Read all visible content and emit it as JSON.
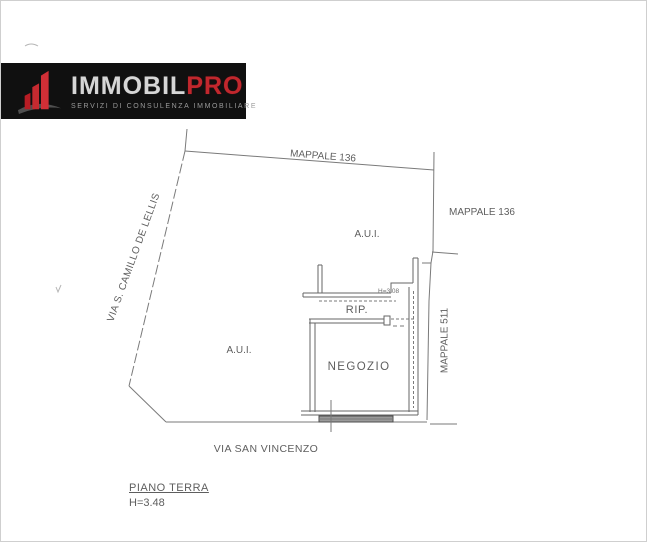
{
  "page": {
    "background": "#ffffff",
    "border_color": "#cfcfcf"
  },
  "logo": {
    "brand_primary": "IMMOBIL",
    "brand_accent": "PRO",
    "tagline": "SERVIZI DI CONSULENZA IMMOBILIARE",
    "colors": {
      "background": "#101010",
      "primary_text": "#d6d6d6",
      "accent_text": "#c1272d",
      "tagline_text": "#9a9a9a",
      "icon_red": "#c62a30",
      "icon_gray": "#4f4f4f"
    }
  },
  "plan": {
    "colors": {
      "boundary_line": "#7a7a7a",
      "wall_line": "#666666",
      "label_text": "#5e5e5e"
    },
    "labels": {
      "mappale_top": "MAPPALE 136",
      "mappale_right": "MAPPALE 136",
      "mappale_side": "MAPPALE 511",
      "street_left": "VIA S. CAMILLO DE LELLIS",
      "street_bottom": "VIA SAN VINCENZO",
      "area_upper": "A.U.I.",
      "area_lower": "A.U.I.",
      "room_storage": "RIP.",
      "room_shop": "NEGOZIO",
      "ceiling_height_small": "H=3.08"
    }
  },
  "footer": {
    "floor_label": "PIANO TERRA",
    "height_label": "H=3.48"
  }
}
